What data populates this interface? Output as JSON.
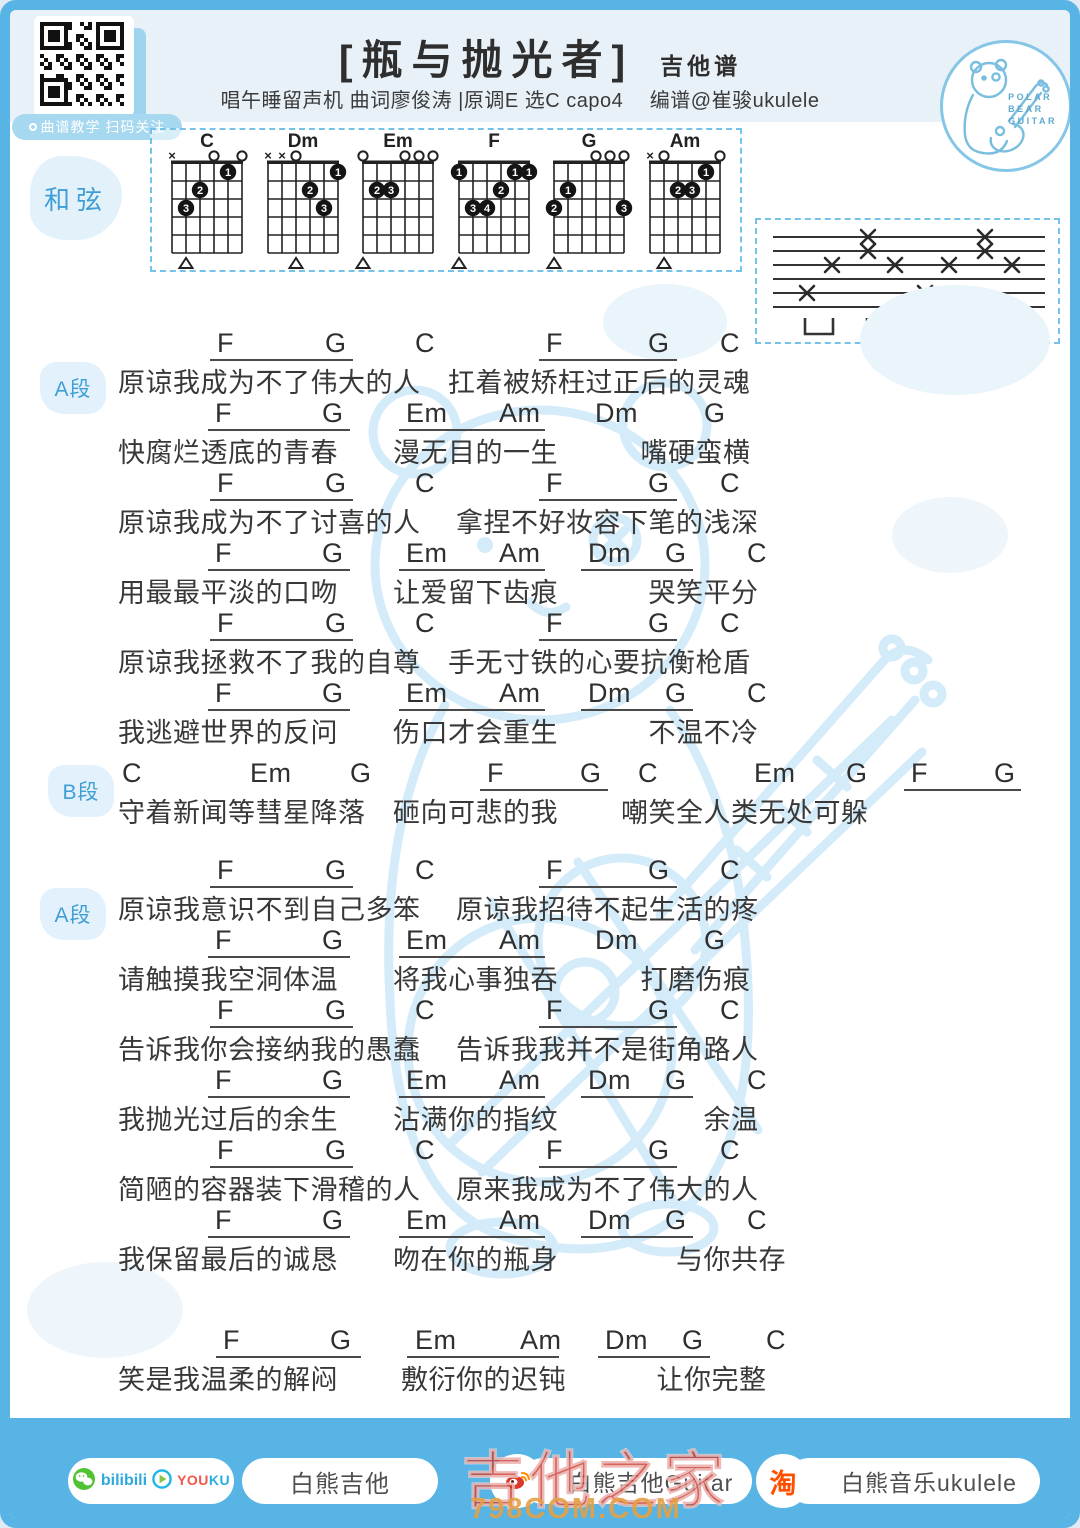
{
  "header": {
    "qr_label": "曲谱教学 扫码关注",
    "title": "[瓶与抛光者]",
    "title_suffix": "吉他谱",
    "subtitle": "唱午睡留声机 曲词廖俊涛  |原调E 选C capo4　 编谱@崔骏ukulele",
    "logo_text": [
      "POLAR",
      "BEAR",
      "GUITAR"
    ]
  },
  "chords_panel": {
    "label": "和弦"
  },
  "chord_diagrams": [
    {
      "name": "C",
      "markers": [
        "x",
        "",
        "",
        "o",
        "",
        "o"
      ],
      "dots": [
        [
          2,
          3,
          "3"
        ],
        [
          3,
          2,
          "2"
        ],
        [
          5,
          1,
          "1"
        ]
      ],
      "bass": 2
    },
    {
      "name": "Dm",
      "markers": [
        "x",
        "x",
        "o",
        "",
        "",
        ""
      ],
      "dots": [
        [
          4,
          2,
          "2"
        ],
        [
          5,
          3,
          "3"
        ],
        [
          6,
          1,
          "1"
        ]
      ],
      "bass": 3
    },
    {
      "name": "Em",
      "markers": [
        "o",
        "",
        "",
        "o",
        "o",
        "o"
      ],
      "dots": [
        [
          2,
          2,
          "2"
        ],
        [
          3,
          2,
          "3"
        ]
      ],
      "bass": 1
    },
    {
      "name": "F",
      "markers": [
        "",
        "",
        "",
        "",
        "",
        ""
      ],
      "dots": [
        [
          1,
          1,
          "1"
        ],
        [
          5,
          1,
          "1"
        ],
        [
          6,
          1,
          "1"
        ],
        [
          4,
          2,
          "2"
        ],
        [
          2,
          3,
          "3"
        ],
        [
          3,
          3,
          "4"
        ]
      ],
      "bass": 1
    },
    {
      "name": "G",
      "markers": [
        "",
        "",
        "",
        "o",
        "o",
        "o"
      ],
      "dots": [
        [
          2,
          2,
          "1"
        ],
        [
          1,
          3,
          "2"
        ],
        [
          6,
          3,
          "3"
        ]
      ],
      "bass": 1
    },
    {
      "name": "Am",
      "markers": [
        "x",
        "o",
        "",
        "",
        "",
        "o"
      ],
      "dots": [
        [
          5,
          1,
          "1"
        ],
        [
          3,
          2,
          "2"
        ],
        [
          4,
          2,
          "3"
        ]
      ],
      "bass": 2
    }
  ],
  "strum_pattern": {
    "string_count": 6,
    "marks": [
      {
        "line": 1,
        "x": [
          111,
          228
        ]
      },
      {
        "line": 2,
        "x": [
          111,
          228
        ]
      },
      {
        "line": 3,
        "x": [
          75,
          138,
          192,
          255
        ]
      },
      {
        "line": 5,
        "x": [
          50,
          168
        ]
      }
    ],
    "brackets": [
      62,
      124,
      183,
      241
    ]
  },
  "row_templates": {
    "A": {
      "chords": [
        {
          "t": "F",
          "x": 207
        },
        {
          "t": "G",
          "x": 315
        },
        {
          "t": "C",
          "x": 405
        },
        {
          "t": "F",
          "x": 536
        },
        {
          "t": "G",
          "x": 638
        },
        {
          "t": "C",
          "x": 710
        }
      ],
      "lines": [
        {
          "x": 200,
          "w": 143
        },
        {
          "x": 529,
          "w": 138
        }
      ]
    },
    "B": {
      "chords": [
        {
          "t": "F",
          "x": 205
        },
        {
          "t": "G",
          "x": 312
        },
        {
          "t": "Em",
          "x": 396
        },
        {
          "t": "Am",
          "x": 489
        },
        {
          "t": "Dm",
          "x": 585
        },
        {
          "t": "G",
          "x": 694
        }
      ],
      "lines": [
        {
          "x": 198,
          "w": 142
        },
        {
          "x": 389,
          "w": 146
        }
      ]
    },
    "C": {
      "chords": [
        {
          "t": "F",
          "x": 205
        },
        {
          "t": "G",
          "x": 312
        },
        {
          "t": "Em",
          "x": 396
        },
        {
          "t": "Am",
          "x": 489
        },
        {
          "t": "Dm",
          "x": 578
        },
        {
          "t": "G",
          "x": 655
        },
        {
          "t": "C",
          "x": 737
        }
      ],
      "lines": [
        {
          "x": 198,
          "w": 142
        },
        {
          "x": 389,
          "w": 146
        },
        {
          "x": 571,
          "w": 112
        }
      ]
    },
    "C2": {
      "chords": [
        {
          "t": "F",
          "x": 213
        },
        {
          "t": "G",
          "x": 320
        },
        {
          "t": "Em",
          "x": 405
        },
        {
          "t": "Am",
          "x": 510
        },
        {
          "t": "Dm",
          "x": 595
        },
        {
          "t": "G",
          "x": 672
        },
        {
          "t": "C",
          "x": 756
        }
      ],
      "lines": [
        {
          "x": 206,
          "w": 145
        },
        {
          "x": 397,
          "w": 152
        },
        {
          "x": 588,
          "w": 112
        }
      ]
    },
    "S": {
      "chords": [
        {
          "t": "C",
          "x": 112
        },
        {
          "t": "Em",
          "x": 240
        },
        {
          "t": "G",
          "x": 340
        },
        {
          "t": "F",
          "x": 477
        },
        {
          "t": "G",
          "x": 570
        },
        {
          "t": "C",
          "x": 628
        },
        {
          "t": "Em",
          "x": 744
        },
        {
          "t": "G",
          "x": 836
        },
        {
          "t": "F",
          "x": 901
        },
        {
          "t": "G",
          "x": 984
        }
      ],
      "lines": [
        {
          "x": 470,
          "w": 128
        },
        {
          "x": 894,
          "w": 117
        }
      ]
    }
  },
  "sections": [
    {
      "label": "A段",
      "rows": [
        {
          "type": "A",
          "lyric": "原谅我成为不了伟大的人　扛着被矫枉过正后的灵魂"
        },
        {
          "type": "B",
          "lyric": "快腐烂透底的青春　　漫无目的一生　　　嘴硬蛮横"
        },
        {
          "type": "A",
          "lyric": "原谅我成为不了讨喜的人　 拿捏不好妆容下笔的浅深"
        },
        {
          "type": "C",
          "lyric": "用最最平淡的口吻　　让爱留下齿痕　　　 哭笑平分"
        },
        {
          "type": "A",
          "lyric": "原谅我拯救不了我的自尊　手无寸铁的心要抗衡枪盾"
        },
        {
          "type": "C",
          "lyric": "我逃避世界的反问　　伤口才会重生　　　 不温不冷"
        }
      ]
    },
    {
      "label": "B段",
      "rows": [
        {
          "type": "S",
          "lyric": "守着新闻等彗星降落　砸向可悲的我　　 嘲笑全人类无处可躲"
        }
      ]
    },
    {
      "label": "A段",
      "rows": [
        {
          "type": "A",
          "lyric": "原谅我意识不到自己多笨　 原谅我招待不起生活的疼"
        },
        {
          "type": "B",
          "lyric": "请触摸我空洞体温　　将我心事独吞　　　打磨伤痕"
        },
        {
          "type": "A",
          "lyric": "告诉我你会接纳我的愚蠢　 告诉我我并不是街角路人"
        },
        {
          "type": "C",
          "lyric": "我抛光过后的余生　　沾满你的指纹　　　　　 余温"
        },
        {
          "type": "A",
          "lyric": "简陋的容器装下滑稽的人　 原来我成为不了伟大的人"
        },
        {
          "type": "C",
          "lyric": "我保留最后的诚恳　　吻在你的瓶身　　　　 与你共存"
        }
      ]
    },
    {
      "label": "",
      "rows": [
        {
          "type": "C2",
          "lyric": "笑是我温柔的解闷　　 敷衍你的迟钝　　　 让你完整"
        }
      ]
    }
  ],
  "footer": {
    "bilibili_text": "bilibili",
    "youku_you": "YOU",
    "youku_ku": "KU",
    "pill_guitar": "白熊吉他",
    "pill_weibo": "白熊吉他Guitar",
    "taobao_char": "淘",
    "pill_taobao": "白熊音乐ukulele"
  },
  "watermark": {
    "line1": "吉他之家",
    "line2": "798COM.COM"
  },
  "colors": {
    "frame_blue": "#58b4e4",
    "band_blue": "#e9f1f8",
    "accent_blue": "#3f9fd4",
    "ink": "#333333"
  }
}
